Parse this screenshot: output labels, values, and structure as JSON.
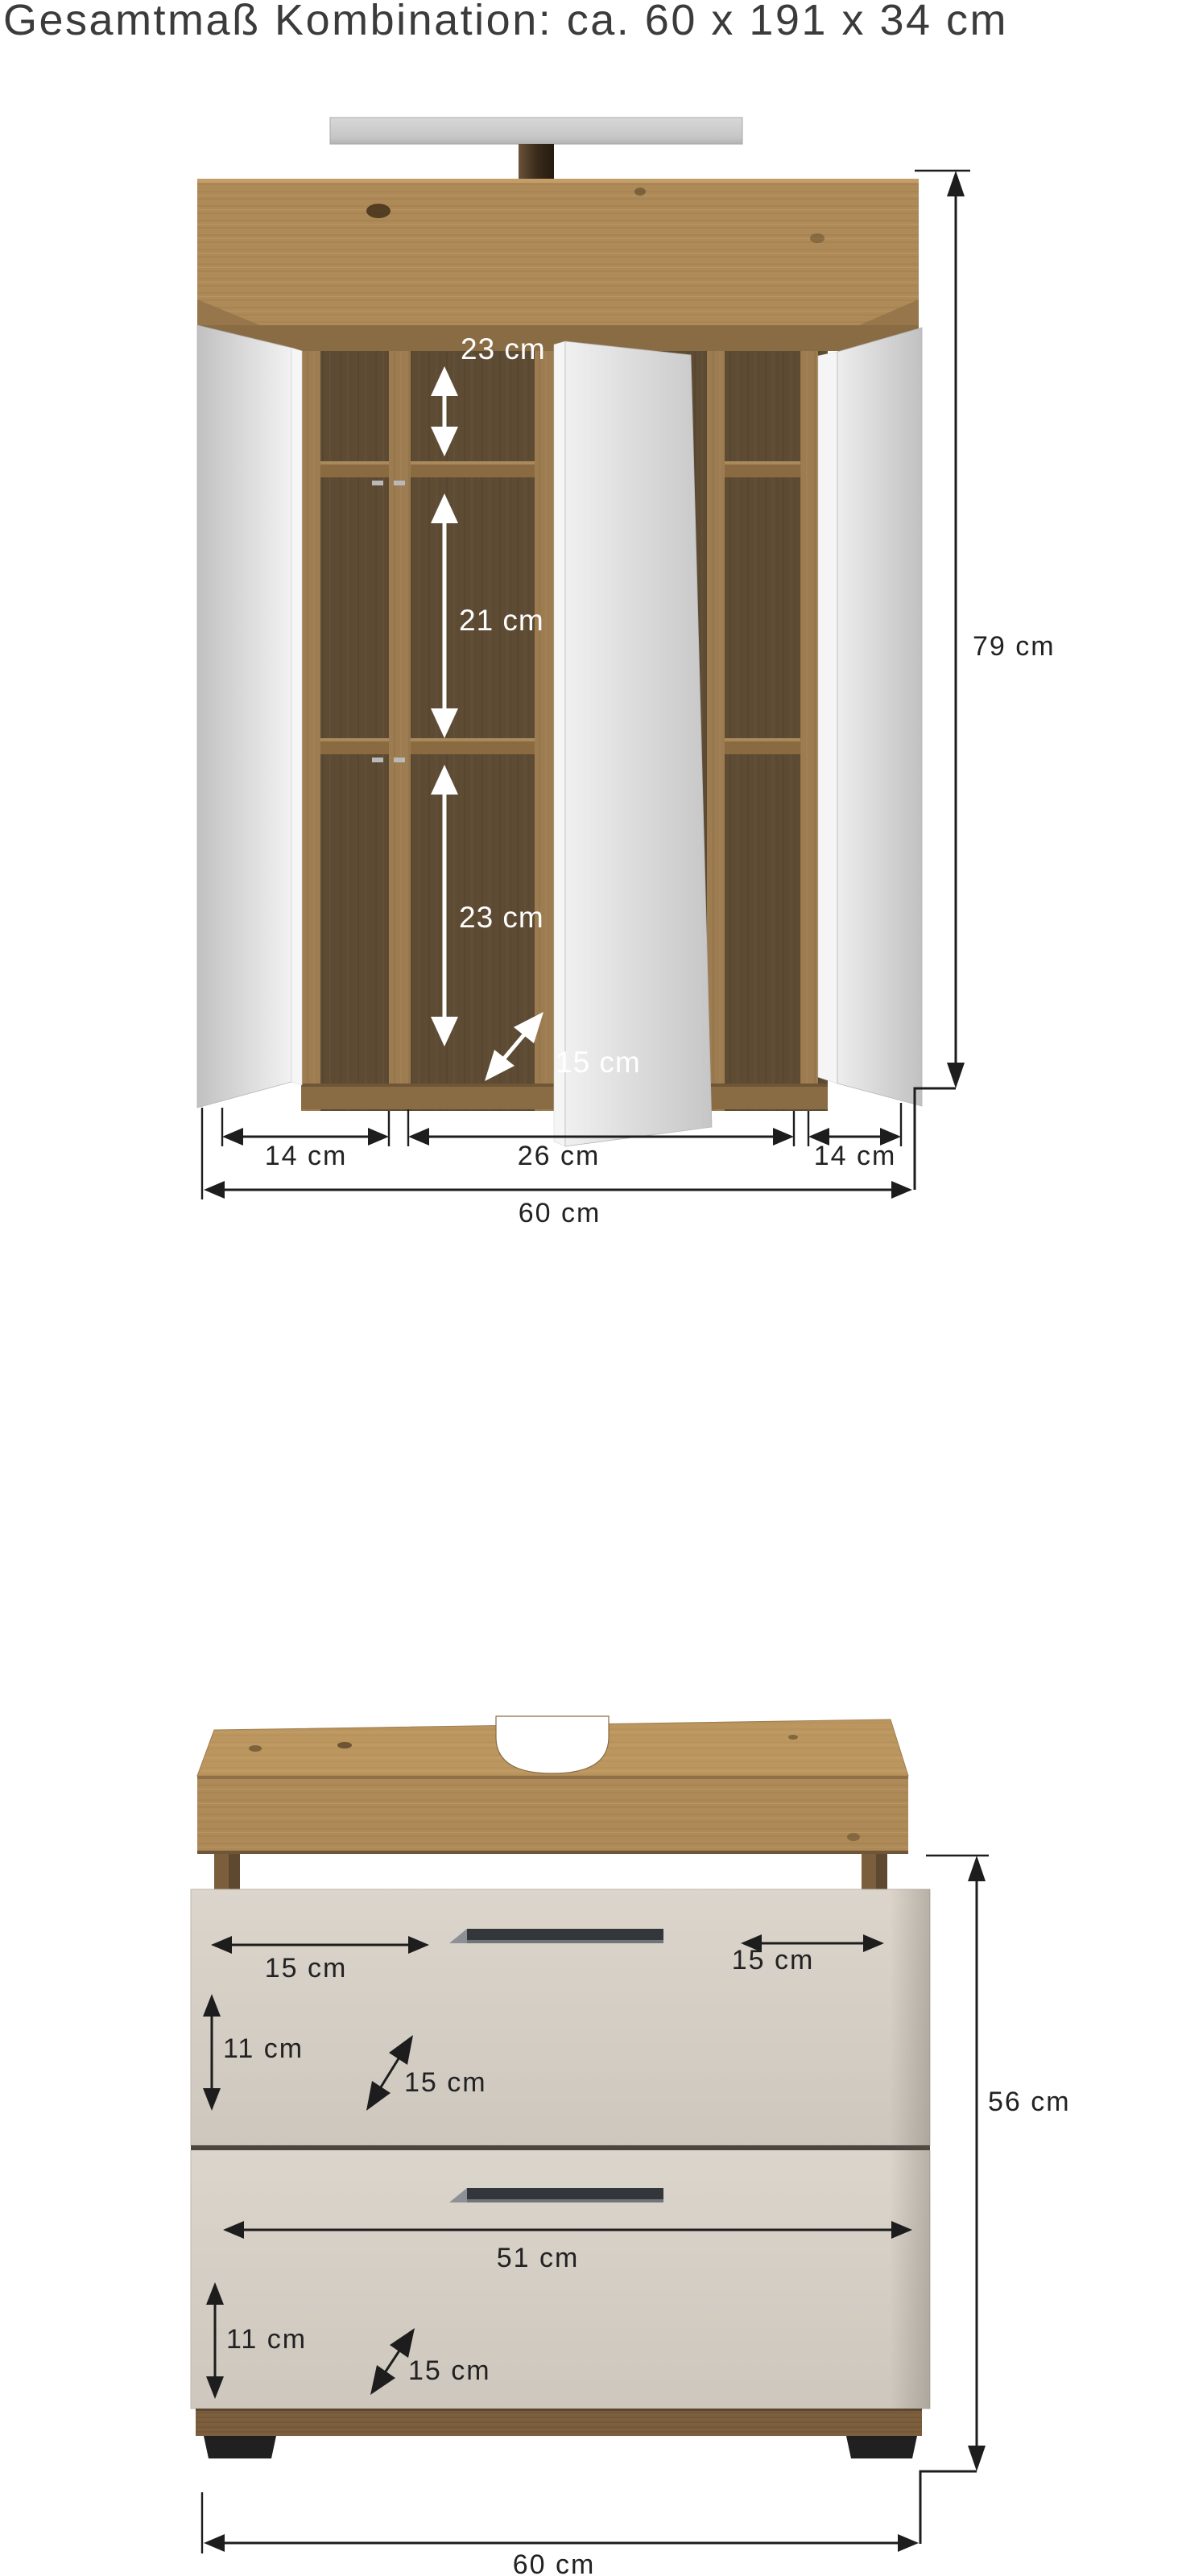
{
  "title": "Gesamtmaß Kombination: ca. 60 x 191 x 34 cm",
  "colors": {
    "wood_light": "#ad8a58",
    "wood_top": "#bb975f",
    "wood_interior_dark": "#5e4b34",
    "plinth_wood": "#7c5f3e",
    "mirror_gray": "#d9d9d9",
    "drawer_front": "#d5cfc6",
    "handle_dark": "#33373c",
    "dimension_text": "#222222"
  },
  "mirror_cabinet": {
    "dims": {
      "shelf_top": "23 cm",
      "shelf_middle": "21 cm",
      "shelf_bottom": "23 cm",
      "depth": "15 cm",
      "height": "79 cm",
      "left_door_width": "14 cm",
      "center_width": "26 cm",
      "right_door_width": "14 cm",
      "total_width": "60 cm"
    }
  },
  "base_cabinet": {
    "dims": {
      "handle_left": "15 cm",
      "handle_right": "15 cm",
      "drawer1_front": "11 cm",
      "drawer1_depth": "15 cm",
      "drawer2_width": "51 cm",
      "drawer2_front": "11 cm",
      "drawer2_depth": "15 cm",
      "height": "56 cm",
      "total_width": "60 cm"
    }
  }
}
